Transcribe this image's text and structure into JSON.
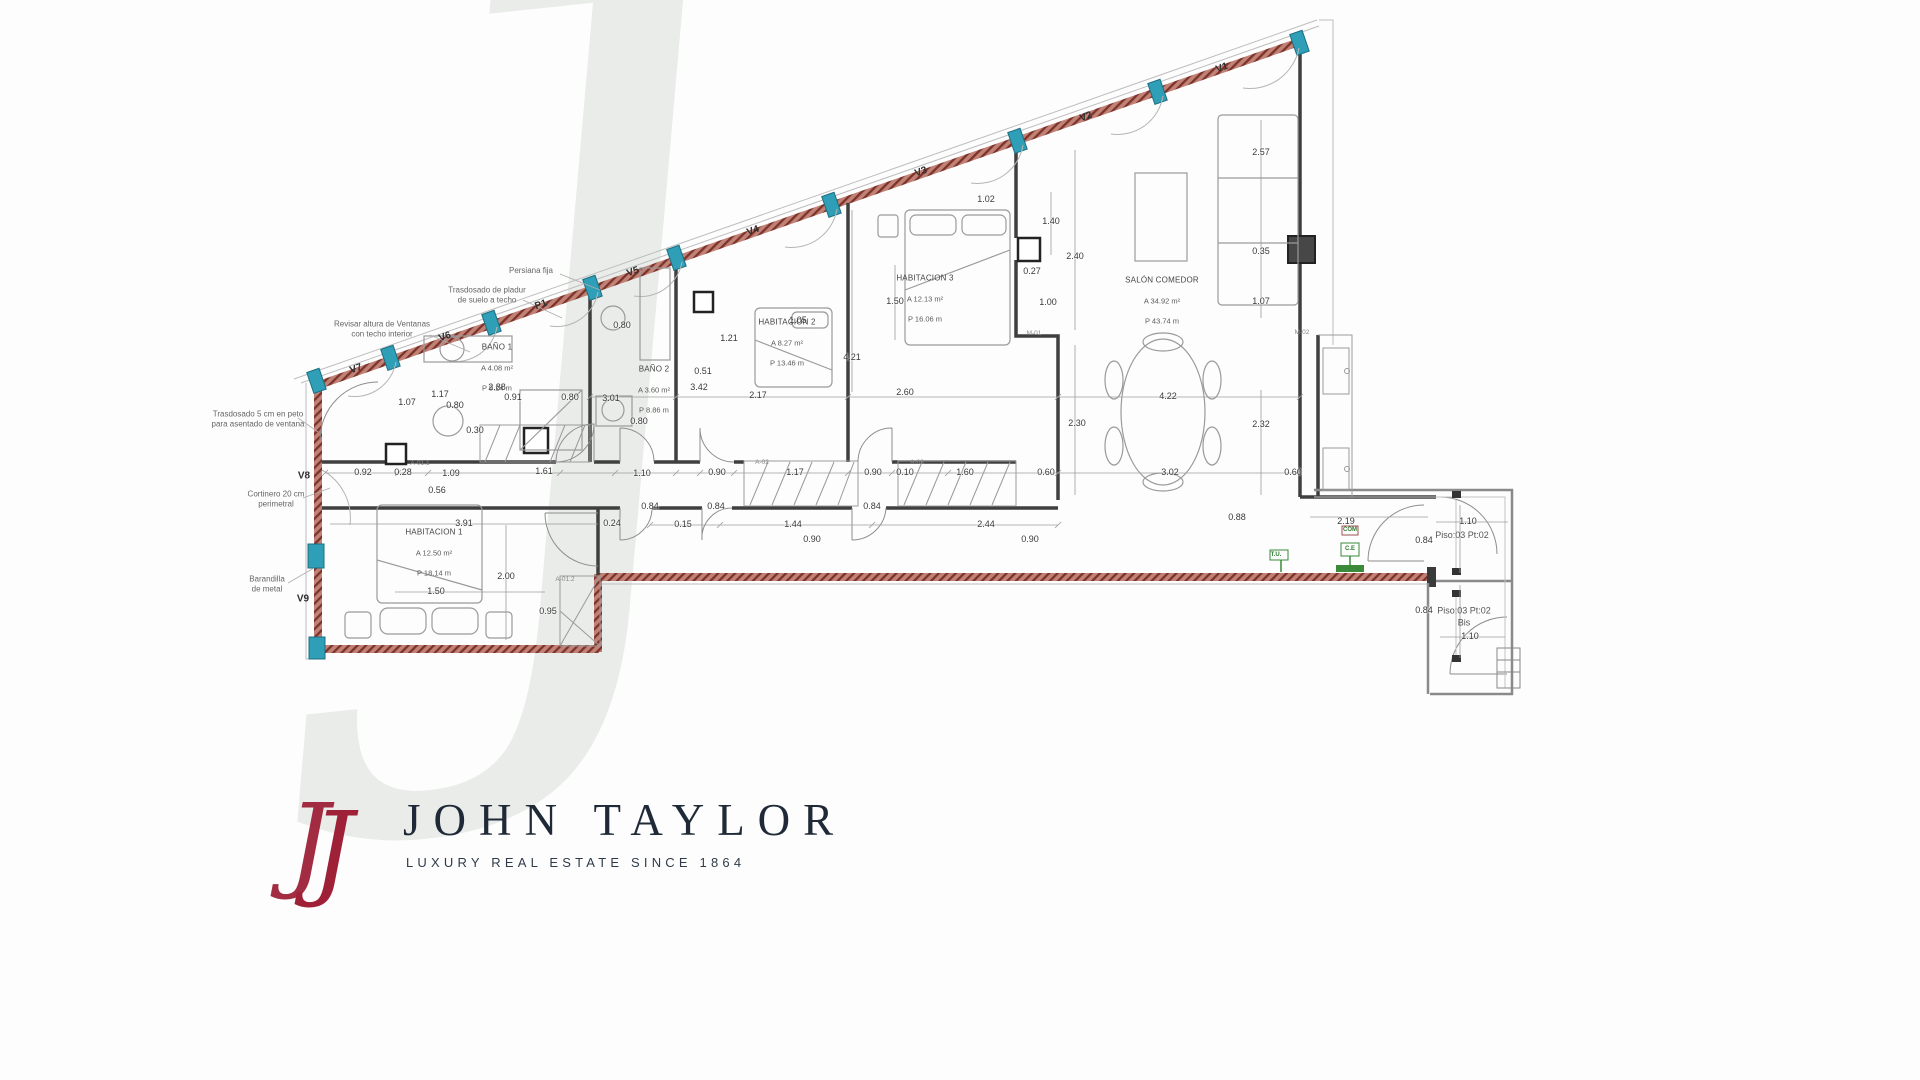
{
  "watermark": "J",
  "logo": {
    "monogram": "J",
    "brand": "JOHN TAYLOR",
    "tagline": "LUXURY REAL ESTATE SINCE 1864"
  },
  "colors": {
    "wall_hatch": "#7e332a",
    "window_marker": "#2f9fb8",
    "interior_wall": "#3f3f3f",
    "logo_red": "#9e2138",
    "logo_navy": "#1f2937",
    "utility_green": "#3a8a3a",
    "watermark_gray": "#e9ece9"
  },
  "plan": {
    "rooms": [
      {
        "name": "HABITACION 1",
        "area": "A 12.50 m²",
        "perimeter": "P 18.14 m",
        "x": 434,
        "y": 553
      },
      {
        "name": "BAÑO 1",
        "area": "A 4.08 m²",
        "perimeter": "P 9.24 m",
        "x": 497,
        "y": 368
      },
      {
        "name": "BAÑO 2",
        "area": "A 3.60 m²",
        "perimeter": "P 8.86 m",
        "x": 654,
        "y": 390
      },
      {
        "name": "HABITACION 2",
        "area": "A 8.27 m²",
        "perimeter": "P 13.46 m",
        "x": 787,
        "y": 343
      },
      {
        "name": "HABITACION 3",
        "area": "A 12.13 m²",
        "perimeter": "P 16.06 m",
        "x": 925,
        "y": 299
      },
      {
        "name": "SALÓN COMEDOR",
        "area": "A 34.92 m²",
        "perimeter": "P 43.74 m",
        "x": 1162,
        "y": 301
      }
    ],
    "openings": [
      {
        "label": "V1",
        "x": 1222,
        "y": 68,
        "angle": -19
      },
      {
        "label": "V2",
        "x": 1086,
        "y": 117,
        "angle": -19
      },
      {
        "label": "V3",
        "x": 921,
        "y": 172,
        "angle": -19
      },
      {
        "label": "V4",
        "x": 753,
        "y": 231,
        "angle": -19
      },
      {
        "label": "V5",
        "x": 633,
        "y": 272,
        "angle": -19
      },
      {
        "label": "P1",
        "x": 541,
        "y": 305,
        "angle": -19
      },
      {
        "label": "V6",
        "x": 445,
        "y": 337,
        "angle": -19
      },
      {
        "label": "V7",
        "x": 356,
        "y": 369,
        "angle": -19
      },
      {
        "label": "V8",
        "x": 304,
        "y": 476,
        "angle": 0
      },
      {
        "label": "V9",
        "x": 303,
        "y": 599,
        "angle": 0
      }
    ],
    "annotations": [
      {
        "text": "Persiana fija",
        "x": 531,
        "y": 271
      },
      {
        "text": "Trasdosado de pladur\nde suelo a techo",
        "x": 487,
        "y": 296
      },
      {
        "text": "Revisar altura de Ventanas\ncon techo interior",
        "x": 382,
        "y": 330
      },
      {
        "text": "Trasdosado 5 cm en peto\npara asentado de ventana",
        "x": 258,
        "y": 420
      },
      {
        "text": "Cortinero 20 cm\nperimetral",
        "x": 276,
        "y": 500
      },
      {
        "text": "Barandilla\nde metal",
        "x": 267,
        "y": 585
      }
    ],
    "landings": [
      {
        "text": "Piso:03 Pt:02",
        "x": 1462,
        "y": 536
      },
      {
        "text": "Piso:03 Pt:02\nBis",
        "x": 1464,
        "y": 617
      }
    ],
    "modules": [
      {
        "text": "M-01",
        "x": 1034,
        "y": 334
      },
      {
        "text": "M-02",
        "x": 1302,
        "y": 333
      },
      {
        "text": "A-01.1",
        "x": 420,
        "y": 464
      },
      {
        "text": "A-01.2",
        "x": 565,
        "y": 580
      },
      {
        "text": "A-02",
        "x": 762,
        "y": 463
      },
      {
        "text": "A-03",
        "x": 917,
        "y": 463
      }
    ],
    "utilities": [
      {
        "text": "T.U.",
        "x": 1276,
        "y": 556
      },
      {
        "text": "COM",
        "x": 1350,
        "y": 531
      },
      {
        "text": "C.E",
        "x": 1350,
        "y": 550
      }
    ],
    "dimensions": [
      {
        "v": "1.50",
        "x": 895,
        "y": 302
      },
      {
        "v": "1.02",
        "x": 986,
        "y": 200
      },
      {
        "v": "1.40",
        "x": 1051,
        "y": 222
      },
      {
        "v": "2.40",
        "x": 1075,
        "y": 257
      },
      {
        "v": "0.27",
        "x": 1032,
        "y": 272
      },
      {
        "v": "1.00",
        "x": 1048,
        "y": 303
      },
      {
        "v": "2.57",
        "x": 1261,
        "y": 153
      },
      {
        "v": "0.35",
        "x": 1261,
        "y": 252
      },
      {
        "v": "1.07",
        "x": 1261,
        "y": 302
      },
      {
        "v": "4.22",
        "x": 1168,
        "y": 397
      },
      {
        "v": "3.02",
        "x": 1170,
        "y": 473
      },
      {
        "v": "2.32",
        "x": 1261,
        "y": 425
      },
      {
        "v": "0.60",
        "x": 1293,
        "y": 473
      },
      {
        "v": "2.30",
        "x": 1077,
        "y": 424
      },
      {
        "v": "0.60",
        "x": 1046,
        "y": 473
      },
      {
        "v": "0.90",
        "x": 1030,
        "y": 540
      },
      {
        "v": "2.19",
        "x": 1346,
        "y": 522
      },
      {
        "v": "1.10",
        "x": 1468,
        "y": 522
      },
      {
        "v": "0.84",
        "x": 1424,
        "y": 541
      },
      {
        "v": "0.84",
        "x": 1424,
        "y": 611
      },
      {
        "v": "1.10",
        "x": 1470,
        "y": 637
      },
      {
        "v": "0.88",
        "x": 1237,
        "y": 518
      },
      {
        "v": "2.17",
        "x": 758,
        "y": 396
      },
      {
        "v": "2.60",
        "x": 905,
        "y": 393
      },
      {
        "v": "4.21",
        "x": 852,
        "y": 358
      },
      {
        "v": "1.05",
        "x": 798,
        "y": 321
      },
      {
        "v": "1.21",
        "x": 729,
        "y": 339
      },
      {
        "v": "0.51",
        "x": 703,
        "y": 372
      },
      {
        "v": "3.42",
        "x": 699,
        "y": 388
      },
      {
        "v": "0.80",
        "x": 622,
        "y": 326
      },
      {
        "v": "3.01",
        "x": 611,
        "y": 399
      },
      {
        "v": "0.80",
        "x": 639,
        "y": 422
      },
      {
        "v": "2.88",
        "x": 497,
        "y": 388
      },
      {
        "v": "1.17",
        "x": 440,
        "y": 395
      },
      {
        "v": "0.91",
        "x": 513,
        "y": 398
      },
      {
        "v": "0.80",
        "x": 570,
        "y": 398
      },
      {
        "v": "1.07",
        "x": 407,
        "y": 403
      },
      {
        "v": "0.80",
        "x": 455,
        "y": 406
      },
      {
        "v": "0.30",
        "x": 475,
        "y": 431
      },
      {
        "v": "0.92",
        "x": 363,
        "y": 473
      },
      {
        "v": "0.28",
        "x": 403,
        "y": 473
      },
      {
        "v": "1.09",
        "x": 451,
        "y": 474
      },
      {
        "v": "0.56",
        "x": 437,
        "y": 491
      },
      {
        "v": "1.61",
        "x": 544,
        "y": 472
      },
      {
        "v": "1.10",
        "x": 642,
        "y": 474
      },
      {
        "v": "0.84",
        "x": 650,
        "y": 507
      },
      {
        "v": "0.84",
        "x": 716,
        "y": 507
      },
      {
        "v": "0.84",
        "x": 872,
        "y": 507
      },
      {
        "v": "0.90",
        "x": 717,
        "y": 473
      },
      {
        "v": "1.17",
        "x": 795,
        "y": 473
      },
      {
        "v": "0.90",
        "x": 873,
        "y": 473
      },
      {
        "v": "0.10",
        "x": 905,
        "y": 473
      },
      {
        "v": "1.60",
        "x": 965,
        "y": 473
      },
      {
        "v": "0.15",
        "x": 683,
        "y": 525
      },
      {
        "v": "1.44",
        "x": 793,
        "y": 525
      },
      {
        "v": "0.90",
        "x": 812,
        "y": 540
      },
      {
        "v": "2.44",
        "x": 986,
        "y": 525
      },
      {
        "v": "3.91",
        "x": 464,
        "y": 524
      },
      {
        "v": "2.00",
        "x": 506,
        "y": 577
      },
      {
        "v": "1.50",
        "x": 436,
        "y": 592
      },
      {
        "v": "0.95",
        "x": 548,
        "y": 612
      },
      {
        "v": "0.24",
        "x": 612,
        "y": 524
      }
    ]
  }
}
